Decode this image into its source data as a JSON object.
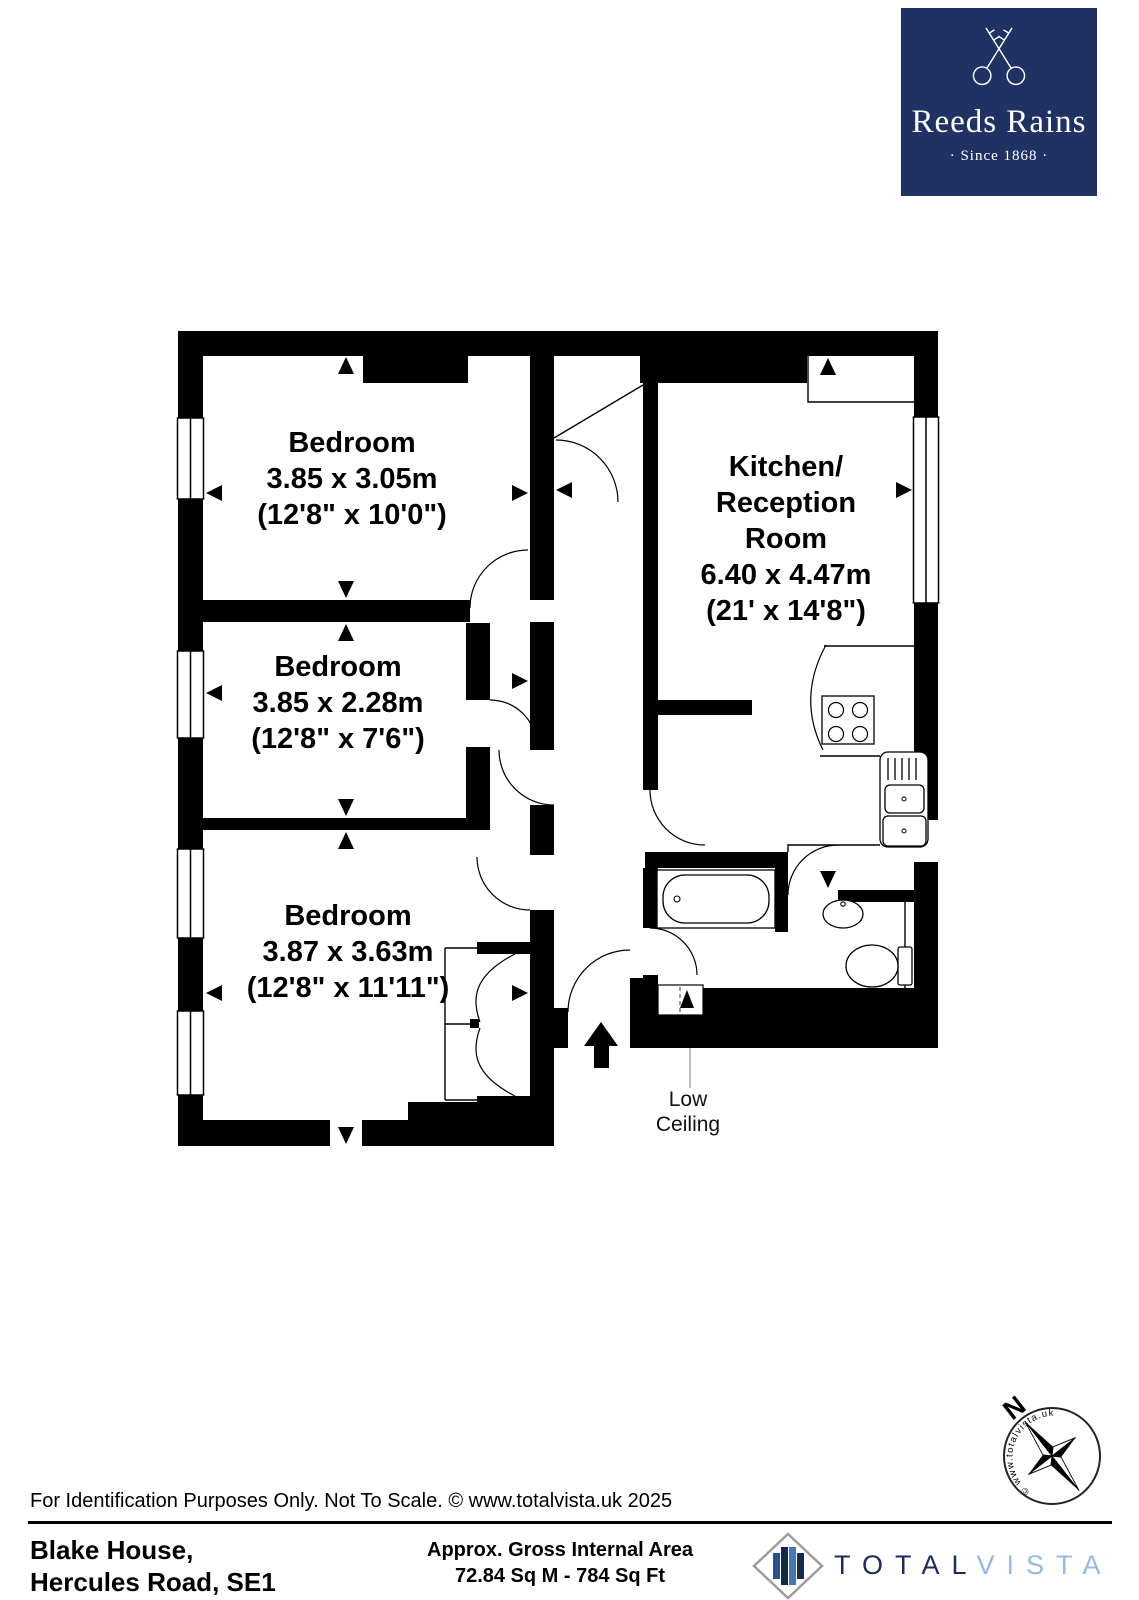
{
  "brand": {
    "name": "Reeds Rains",
    "tagline": "· Since 1868 ·",
    "navy": "#1f3263"
  },
  "plan": {
    "rooms": [
      {
        "name": "Bedroom",
        "metric": "3.85 x 3.05m",
        "imperial": "(12'8\" x 10'0\")"
      },
      {
        "name": "Bedroom",
        "metric": "3.85 x 2.28m",
        "imperial": "(12'8\" x 7'6\")"
      },
      {
        "name": "Bedroom",
        "metric": "3.87 x 3.63m",
        "imperial": "(12'8\" x 11'11\")"
      },
      {
        "lines": [
          "Kitchen/",
          "Reception",
          "Room"
        ],
        "metric": "6.40 x 4.47m",
        "imperial": "(21' x 14'8\")"
      }
    ],
    "low_ceiling": [
      "Low",
      "Ceiling"
    ]
  },
  "disclaimer": "For Identification Purposes Only. Not To Scale. © www.totalvista.uk  2025",
  "footer": {
    "address": [
      "Blake House,",
      "Hercules Road, SE1"
    ],
    "area_label": "Approx. Gross Internal Area",
    "area_value": "72.84 Sq M - 784 Sq Ft",
    "vendor": {
      "part1": "TOTAL",
      "part2": "VISTA",
      "dark": "#1c2d55",
      "light": "#97b9dc"
    }
  },
  "compass": {
    "north": "N",
    "ring_text": "© www.totalvista.uk"
  }
}
